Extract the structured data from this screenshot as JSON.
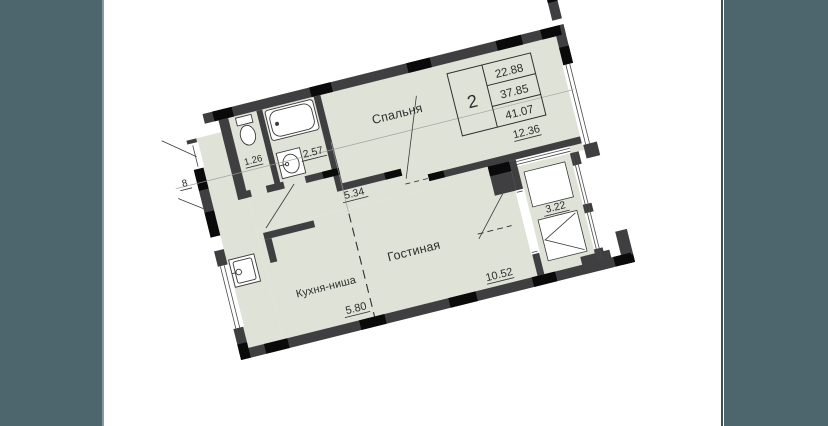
{
  "page": {
    "background": "#ffffff",
    "side_band_color": "#4d666e"
  },
  "plan": {
    "rotation_deg": -14,
    "colors": {
      "floor": "#dfe2d6",
      "wall": "#3f3f41",
      "accent_black": "#0a0a0a",
      "line": "#3c3c3c",
      "axis": "#9b9b9b",
      "fixture_stroke": "#3a3a3a"
    },
    "info_table": {
      "room_count": "2",
      "values": [
        "22.88",
        "37.85",
        "41.07"
      ]
    },
    "labels": {
      "bedroom": {
        "name": "Спальня",
        "area": "12.36"
      },
      "living": {
        "name": "Гостиная",
        "area": "10.52"
      },
      "kitchen": {
        "name": "Кухня-ниша",
        "area": "5.80"
      },
      "hall": {
        "area": "5.34"
      },
      "bathroom": {
        "area": "2.57"
      },
      "wc": {
        "area": "1.26"
      },
      "balcony": {
        "area": "3.22"
      },
      "edge_partial": {
        "area": "8"
      }
    }
  }
}
